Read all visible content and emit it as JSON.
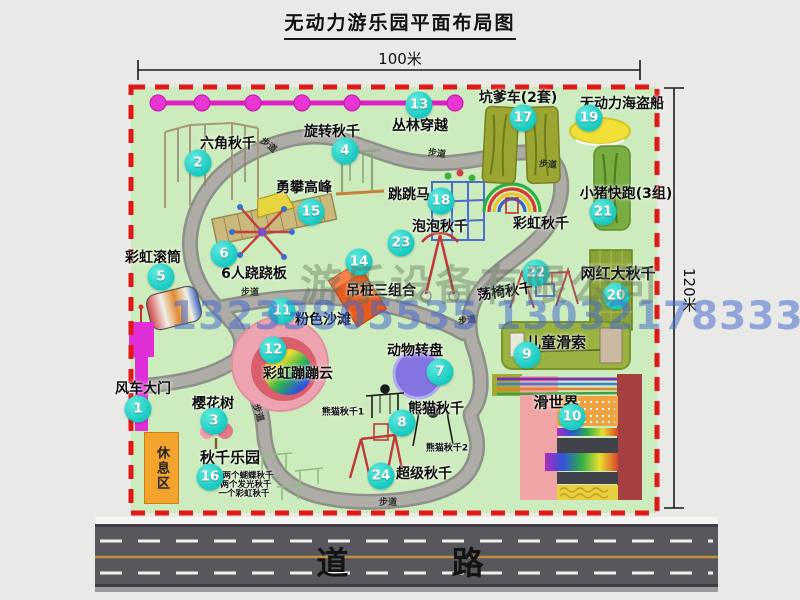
{
  "title": "无动力游乐园平面布局图",
  "dimensions": {
    "width": "100米",
    "height": "120米"
  },
  "road": {
    "label": "道  路"
  },
  "watermark": {
    "company": "游乐设备有限公司",
    "phone": "13233805535 13032178333"
  },
  "colors": {
    "map_bg": "#cdecbd",
    "border_dash": "#e01818",
    "bubble": "#17c9c0",
    "zipline": "#e621cd",
    "road": "#57575d",
    "rest_area": "#f2a32c"
  },
  "attractions": [
    {
      "num": "1",
      "label": "风车大门"
    },
    {
      "num": "2",
      "label": "六角秋千"
    },
    {
      "num": "3",
      "label": "樱花树"
    },
    {
      "num": "4",
      "label": "旋转秋千"
    },
    {
      "num": "5",
      "label": "彩虹滚筒"
    },
    {
      "num": "6",
      "label": "6人跷跷板"
    },
    {
      "num": "7",
      "label": "动物转盘"
    },
    {
      "num": "8",
      "label": "熊猫秋千"
    },
    {
      "num": "9",
      "label": "儿童滑索"
    },
    {
      "num": "10",
      "label": "滑世界"
    },
    {
      "num": "11",
      "label": "粉色沙滩"
    },
    {
      "num": "12",
      "label": "彩虹蹦蹦云"
    },
    {
      "num": "13",
      "label": "丛林穿越"
    },
    {
      "num": "14",
      "label": "吊桩三组合"
    },
    {
      "num": "15",
      "label": "勇攀高峰"
    },
    {
      "num": "16",
      "label": "秋千乐园"
    },
    {
      "num": "17",
      "label": "坑爹车(2套)"
    },
    {
      "num": "18",
      "label": "跳跳马"
    },
    {
      "num": "19",
      "label": "无动力海盗船"
    },
    {
      "num": "20",
      "label": "网红大秋千"
    },
    {
      "num": "21",
      "label": "小猪快跑(3组)"
    },
    {
      "num": "22",
      "label": "荡椅秋千"
    },
    {
      "num": "23",
      "label": "泡泡秋千"
    },
    {
      "num": "24",
      "label": "超级秋千"
    }
  ],
  "extra_labels": {
    "rainbow_swing": "彩虹秋千",
    "rest_area": "休息区",
    "panda_swing_1": "熊猫秋千1",
    "panda_swing_2": "熊猫秋千2",
    "swing_park_note_1": "两个蝴蝶秋千",
    "swing_park_note_2": "两个发光秋千",
    "swing_park_note_3": "一个彩虹秋千",
    "footpath": "步道"
  }
}
